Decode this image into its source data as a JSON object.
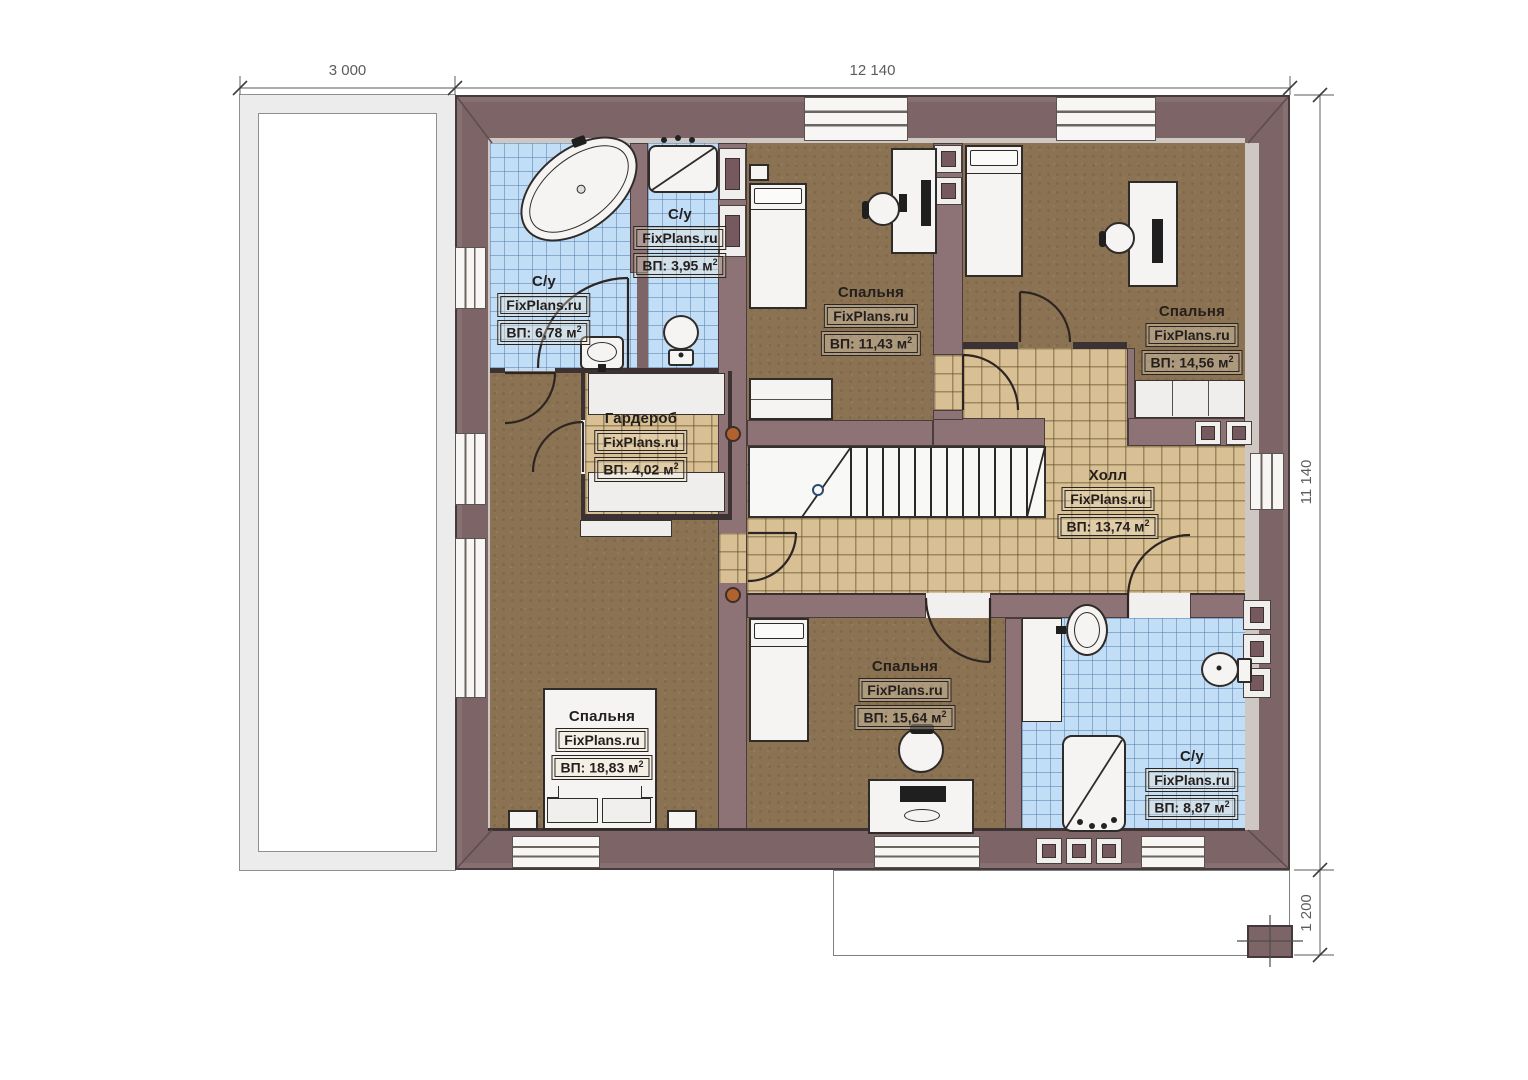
{
  "brand": "FixPlans.ru",
  "sup": "2",
  "dims": {
    "top_left": "3 000",
    "top_main": "12 140",
    "right": "11 140",
    "bottom_right": "1 200"
  },
  "rooms": [
    {
      "id": "bath-top-left",
      "name": "С/у",
      "area": "ВП: 6,78 м"
    },
    {
      "id": "bath-top-mid",
      "name": "С/у",
      "area": "ВП: 3,95 м"
    },
    {
      "id": "bedroom-top-mid",
      "name": "Спальня",
      "area": "ВП: 11,43 м"
    },
    {
      "id": "bedroom-top-right",
      "name": "Спальня",
      "area": "ВП: 14,56 м"
    },
    {
      "id": "wardrobe",
      "name": "Гардероб",
      "area": "ВП: 4,02 м"
    },
    {
      "id": "hall",
      "name": "Холл",
      "area": "ВП: 13,74 м"
    },
    {
      "id": "bedroom-bottom-left",
      "name": "Спальня",
      "area": "ВП: 18,83 м"
    },
    {
      "id": "bedroom-bottom-mid",
      "name": "Спальня",
      "area": "ВП: 15,64 м"
    },
    {
      "id": "bath-bottom-right",
      "name": "С/у",
      "area": "ВП: 8,87 м"
    }
  ],
  "colors": {
    "wall_exterior": "#7c6467",
    "wall_interior": "#8d7276",
    "floor_wood": "#8a7252",
    "tile_hall": "#d8c094",
    "tile_bath": "#c2def7",
    "fixture_white": "#f5f4f2",
    "copper_dot": "#b0622f"
  }
}
